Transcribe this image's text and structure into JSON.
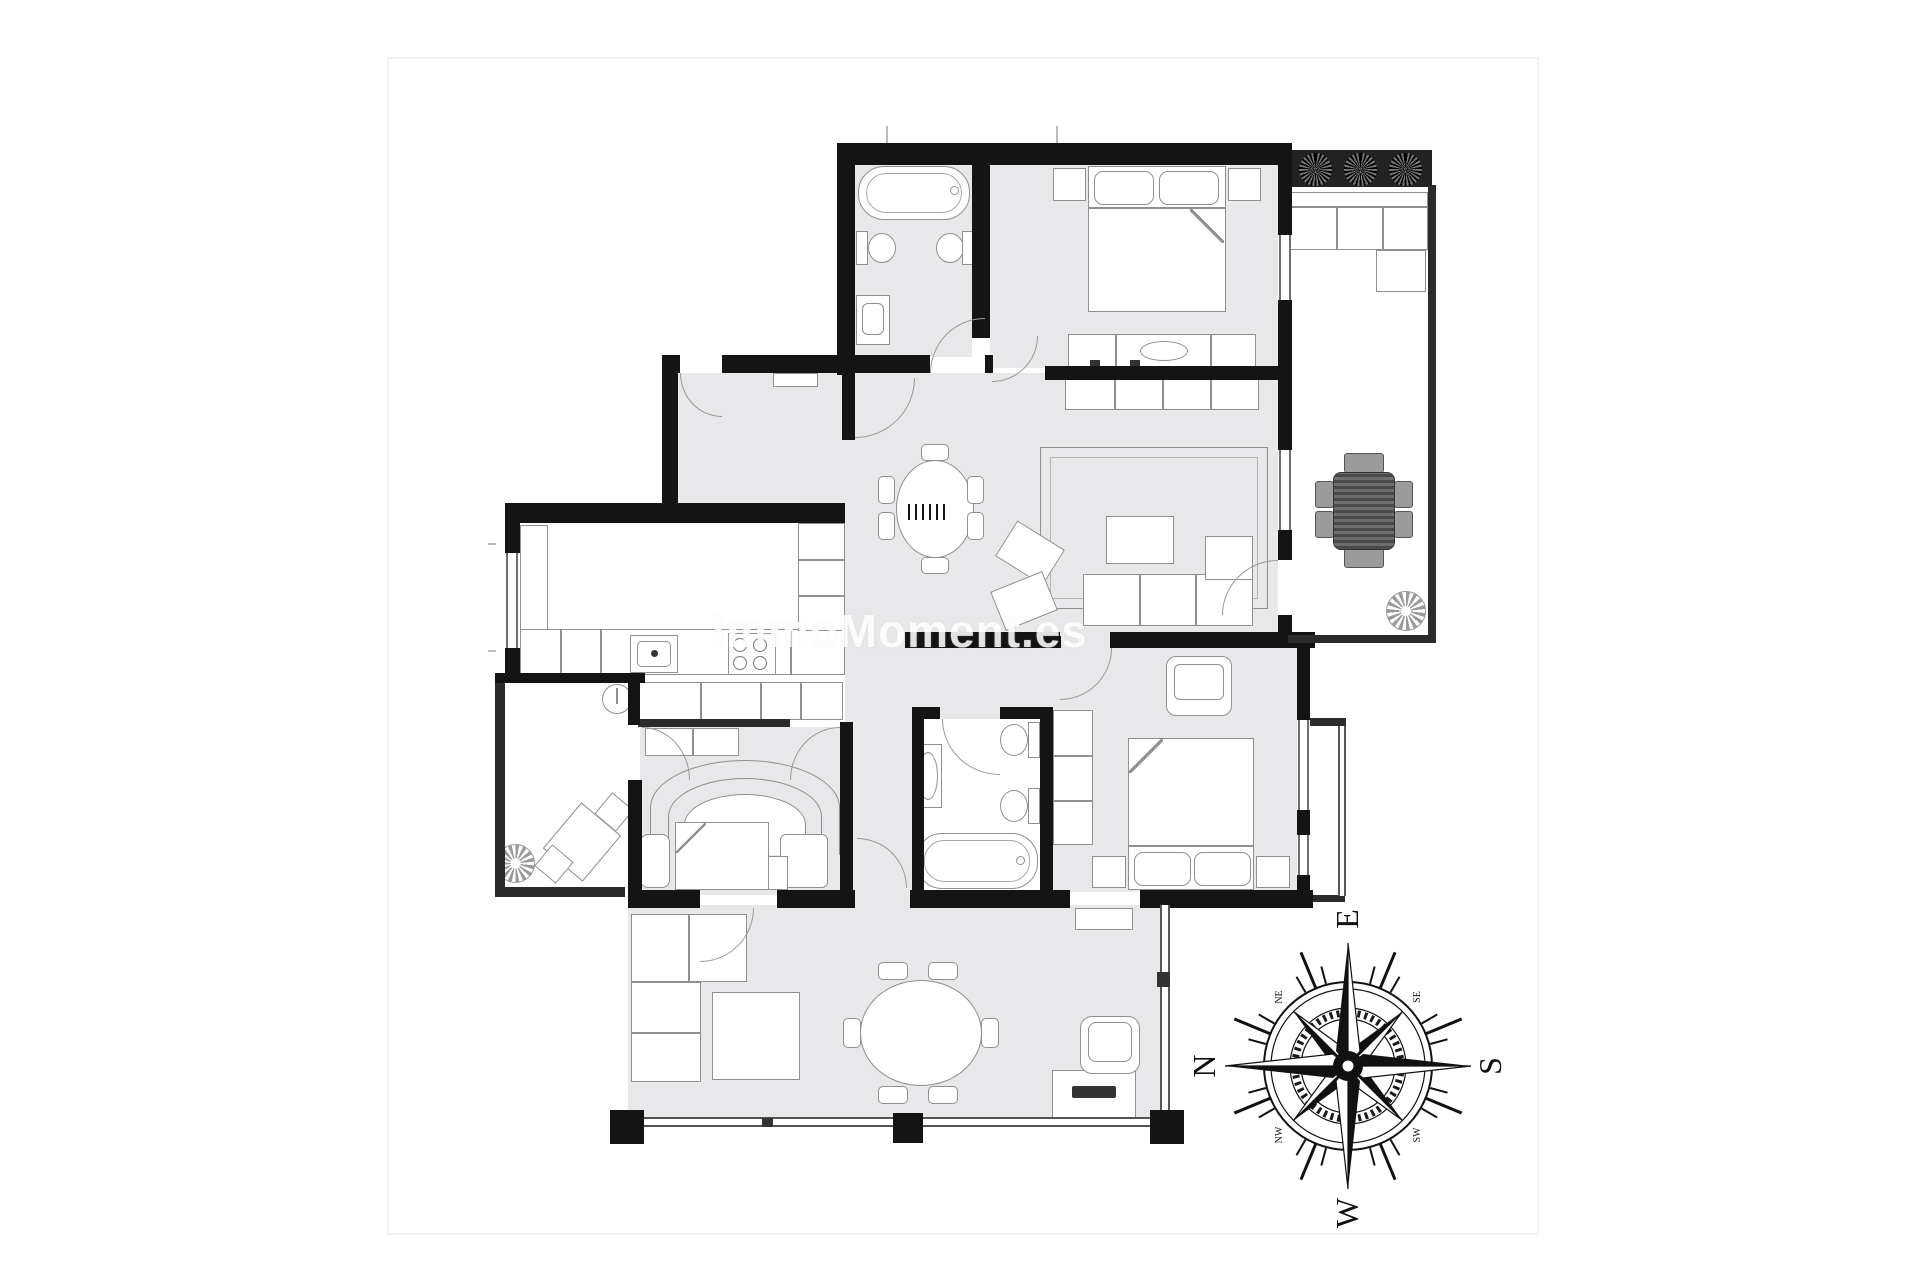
{
  "watermark": {
    "text": "ImmoMoment.es"
  },
  "compass": {
    "cardinal_top": "E",
    "cardinal_right": "S",
    "cardinal_bottom": "W",
    "cardinal_left": "N",
    "inter_top_left": "NE",
    "inter_top_right": "SE",
    "inter_bottom_right": "SW",
    "inter_bottom_left": "NW"
  },
  "colors": {
    "wall": "#141414",
    "floor": "#e8e8ea",
    "furniture_line": "#8f8f8f",
    "planter": "#222222",
    "watermark": "rgba(255,255,255,0.85)",
    "page": "#ffffff"
  }
}
